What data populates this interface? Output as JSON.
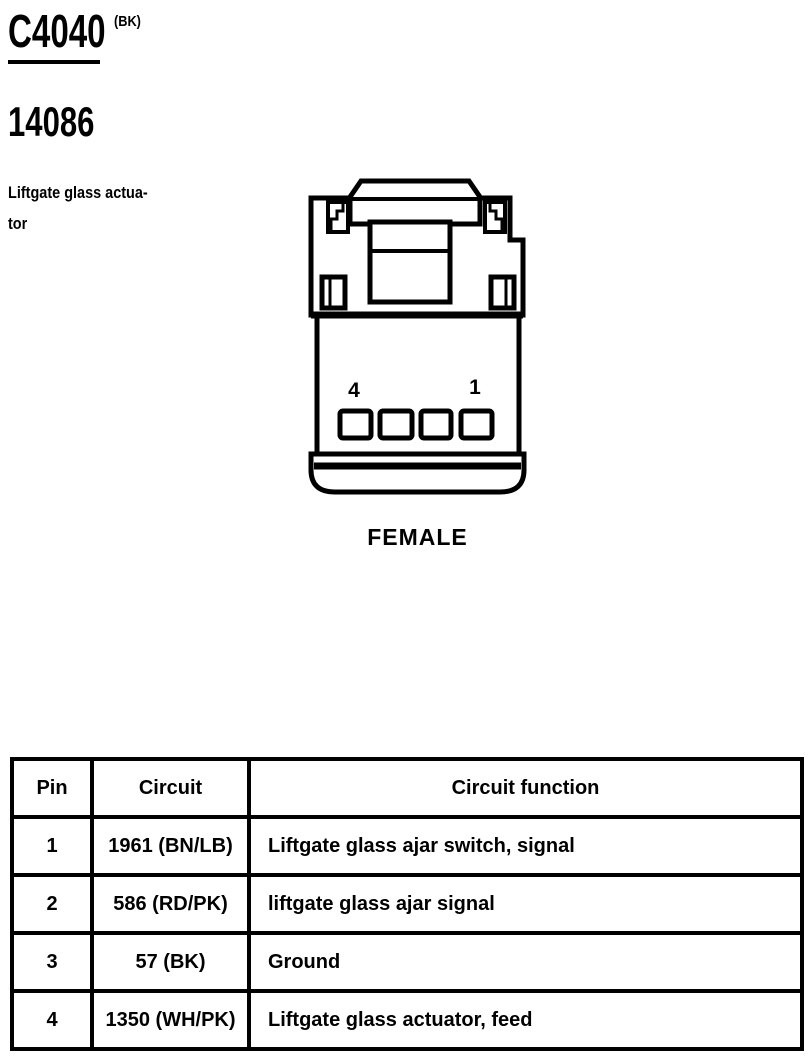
{
  "header": {
    "connector_id": "C4040",
    "connector_color": "(BK)",
    "part_number": "14086"
  },
  "component": {
    "name_line1": "Liftgate glass actua-",
    "name_line2": "tor"
  },
  "diagram": {
    "gender_label": "FEMALE",
    "pin_label_left": "4",
    "pin_label_right": "1"
  },
  "table": {
    "headers": {
      "pin": "Pin",
      "circuit": "Circuit",
      "function": "Circuit function"
    },
    "rows": [
      {
        "pin": "1",
        "circuit": "1961 (BN/LB)",
        "function": "Liftgate glass ajar switch, signal"
      },
      {
        "pin": "2",
        "circuit": "586 (RD/PK)",
        "function": "liftgate glass ajar signal"
      },
      {
        "pin": "3",
        "circuit": "57 (BK)",
        "function": "Ground"
      },
      {
        "pin": "4",
        "circuit": "1350 (WH/PK)",
        "function": "Liftgate glass actuator, feed"
      }
    ]
  },
  "colors": {
    "ink": "#000000",
    "background": "#ffffff"
  }
}
